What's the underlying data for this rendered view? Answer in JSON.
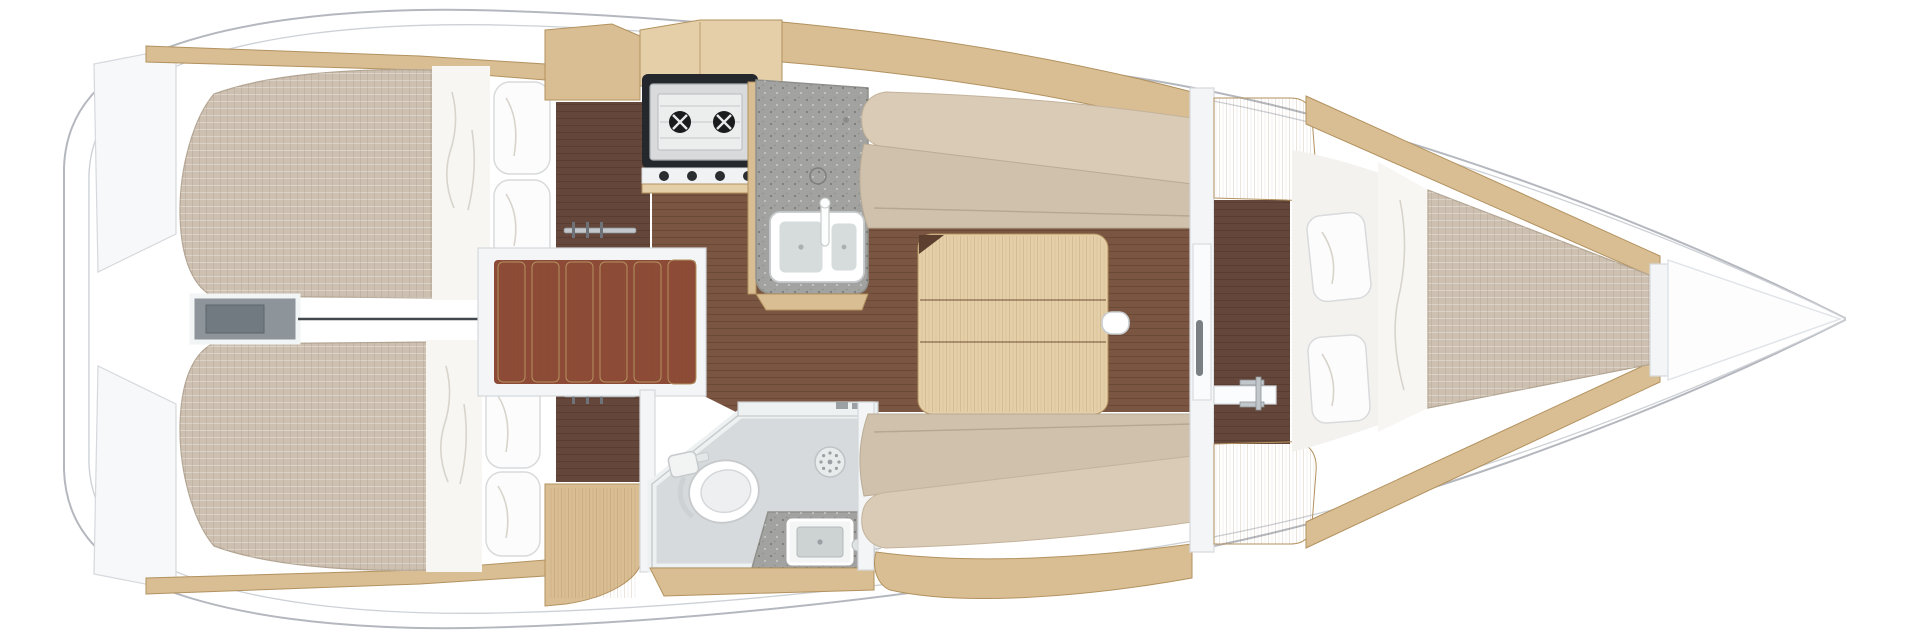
{
  "palette": {
    "page_bg": "#ffffff",
    "hull_fill": "#ffffff",
    "hull_line": "#b4b8be",
    "sheer_line": "#cdd1d6",
    "deck_wedge": "#f6f8f9",
    "wall_white": "#f3f5f7",
    "wall_edge": "#d5d9dd",
    "wood": "#d9bd93",
    "wood_light": "#e4cfa9",
    "wood_edge": "#b2925f",
    "floor": "#7a5642",
    "floor_dark": "#64473a",
    "mattress": "#cdc0b1",
    "mattress_edge": "#b3a593",
    "sheet": "#f3f2ee",
    "blanket": "#f7f6f3",
    "crease": "#d8d4cc",
    "pillow": "#fcfcfc",
    "pillow_edge": "#d8dadc",
    "cushion": "#cfc1ac",
    "bolster": "#dacbb6",
    "counter": "#a2a3a0",
    "counter_edge": "#8f908c",
    "steel": "#d8dadb",
    "steel_dark": "#a9adb0",
    "stove_frame": "#24272b",
    "burner_dark": "#191b1d",
    "bath_floor": "#d7dadc",
    "bath_wall": "#eef1f2",
    "fixture_edge": "#c6cacc",
    "chrome": "#c2c7cb",
    "engine_fill": "#8d949a",
    "engine_inner": "#717a80",
    "line_dark": "#43484d",
    "stair_gap": "#8d4b37"
  },
  "fixtures": {
    "aft_cabins": 2,
    "pillows_per_aft_cabin": 2,
    "forward_cabin_pillows": 2,
    "stove_burners": 2,
    "galley_sink_basins": 2,
    "head_sink_basins": 1,
    "salon_table_sections": 3,
    "companionway_treads": 6,
    "wardrobe_rails": 2
  },
  "regions": [
    "hull",
    "aft-cabin-port",
    "aft-cabin-starboard",
    "engine-compartment",
    "companionway",
    "wardrobe-port",
    "wardrobe-starboard",
    "galley",
    "salon",
    "settee-port",
    "settee-starboard",
    "salon-table",
    "head",
    "forward-cabin",
    "v-berth",
    "anchor-locker",
    "bow"
  ]
}
